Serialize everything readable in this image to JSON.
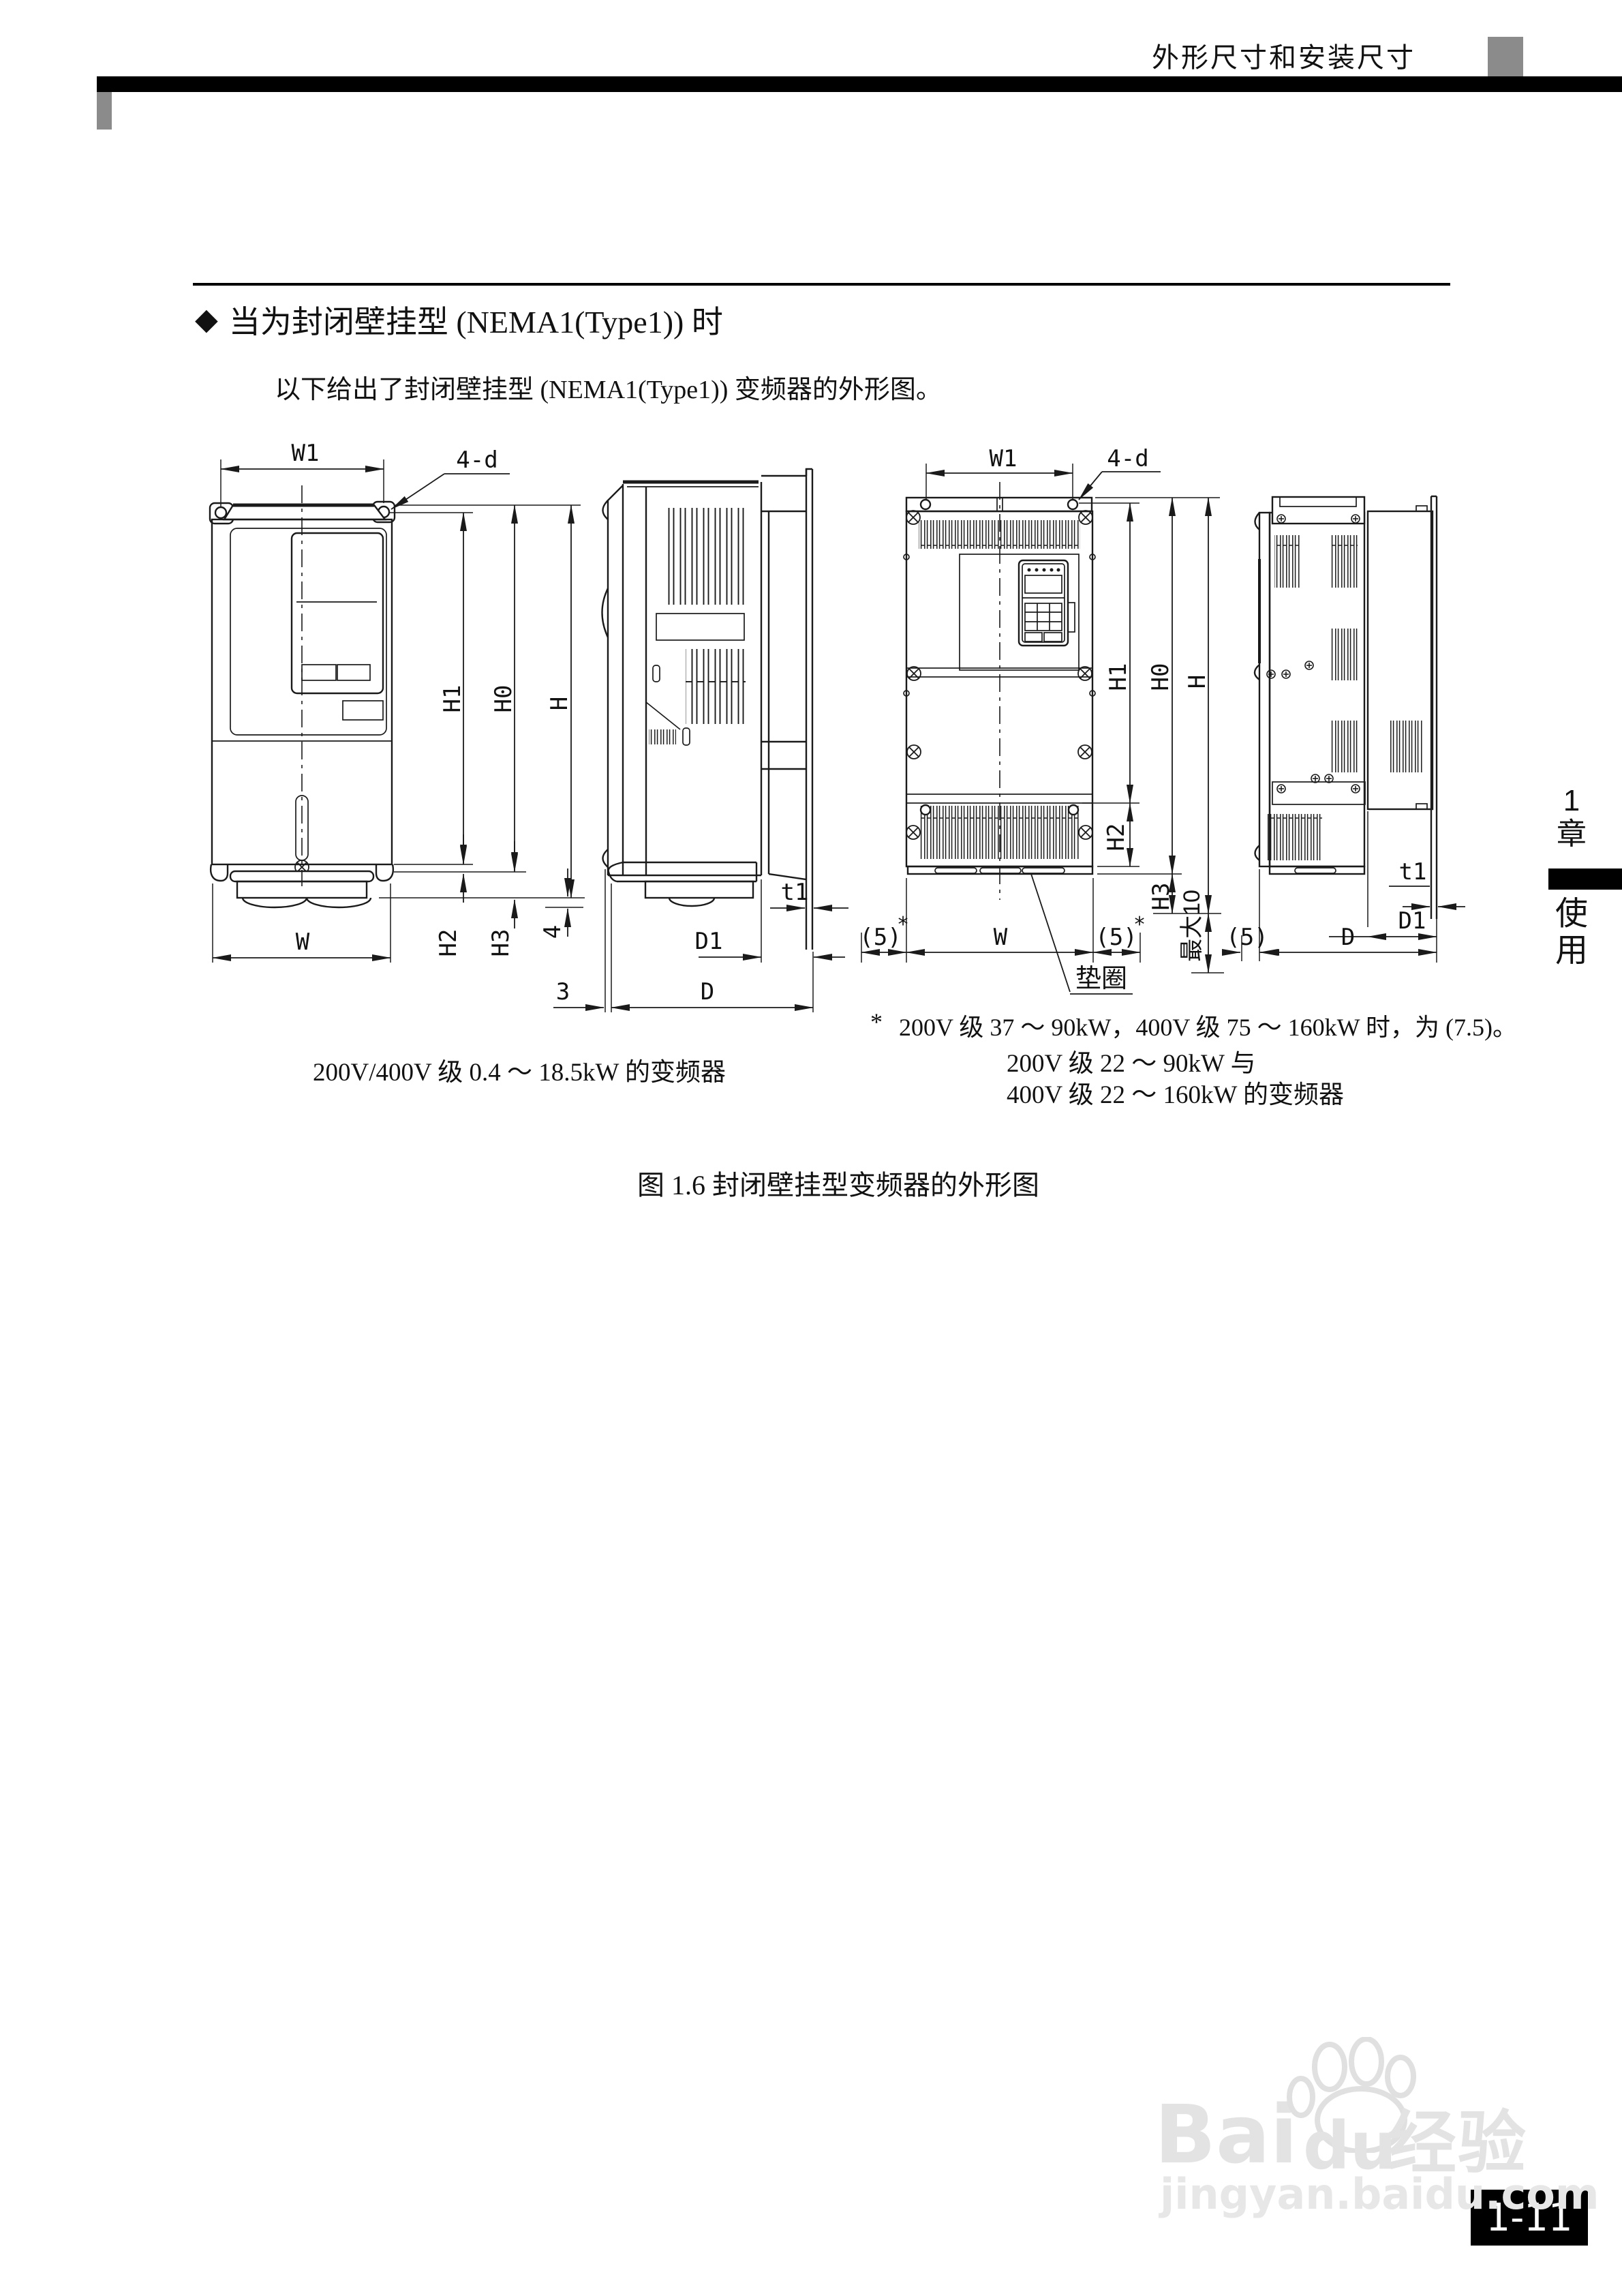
{
  "header": {
    "title": "外形尺寸和安装尺寸"
  },
  "section": {
    "marker": "◆",
    "title": "当为封闭壁挂型 (NEMA1(Type1)) 时",
    "intro": "以下给出了封闭壁挂型 (NEMA1(Type1)) 变频器的外形图。"
  },
  "figure": {
    "caption": "图 1.6  封闭壁挂型变频器的外形图",
    "left_drawing": {
      "caption": "200V/400V 级 0.4 ～ 18.5kW 的变频器",
      "labels": {
        "w1": "W1",
        "holes": "4-d",
        "h1": "H1",
        "h0": "H0",
        "h": "H",
        "w": "W",
        "h2": "H2",
        "h3": "H3",
        "four": "4",
        "t1": "t1",
        "d1": "D1",
        "d": "D",
        "three": "3"
      }
    },
    "right_drawing": {
      "caption_line1": "200V 级 22 ～ 90kW 与",
      "caption_line2": "400V 级 22 ～ 160kW 的变频器",
      "note_marker": "*",
      "note": "200V 级 37 ～ 90kW，400V 级 75 ～ 160kW 时，为 (7.5)。",
      "labels": {
        "w1": "W1",
        "holes": "4-d",
        "h1": "H1",
        "h0": "H0",
        "h": "H",
        "w": "W",
        "h2": "H2",
        "h3": "H3",
        "max10": "最大10",
        "five_left": "(5)",
        "five_right": "(5)",
        "five_side": "(5)",
        "star_left": "*",
        "star_right": "*",
        "washer": "垫圈",
        "t1": "t1",
        "d1": "D1",
        "d": "D"
      }
    }
  },
  "sidebar": {
    "chapter_number": "1",
    "chapter_char": "章",
    "usage_char1": "使",
    "usage_char2": "用"
  },
  "watermark": {
    "brand_bai": "Bai",
    "brand_du": "du",
    "brand_cn": "经验",
    "url": "jingyan.baidu.com"
  },
  "page_number": "1-11"
}
